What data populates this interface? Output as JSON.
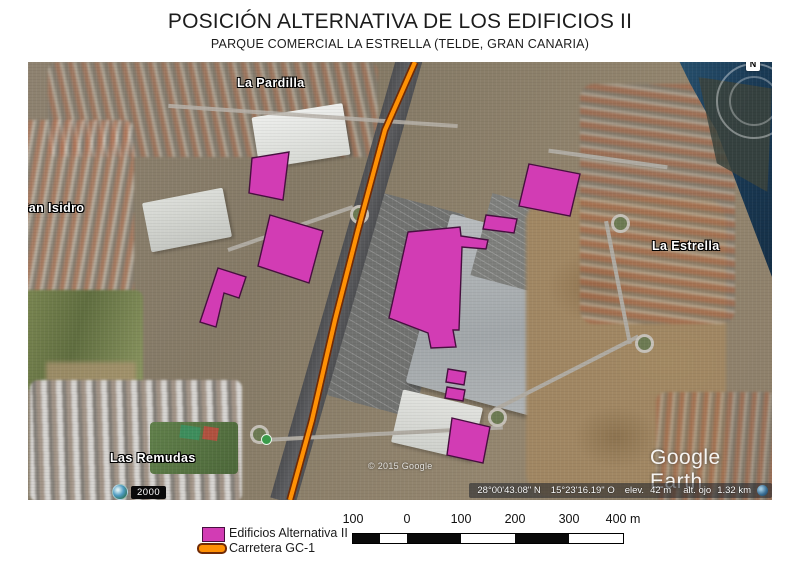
{
  "header": {
    "title": "POSICIÓN ALTERNATIVA DE LOS EDIFICIOS II",
    "subtitle": "PARQUE COMERCIAL LA ESTRELLA (TELDE, GRAN CANARIA)"
  },
  "map": {
    "place_labels": [
      {
        "name": "La Pardilla",
        "x": 209,
        "y": 14
      },
      {
        "name": "San Isidro",
        "x": -8,
        "y": 139
      },
      {
        "name": "La Estrella",
        "x": 624,
        "y": 177
      },
      {
        "name": "Las Remudas",
        "x": 82,
        "y": 389
      }
    ],
    "watermark": "Google Earth",
    "copyright": "© 2015 Google",
    "year_badge": "2000",
    "compass_label": "N",
    "status_bar": {
      "latitude": "28°00'43.08\" N",
      "longitude": "15°23'16.19\" O",
      "elev_label": "elev.",
      "elev_value": "42 m",
      "eye_label": "alt. ojo",
      "eye_value": "1.32 km"
    },
    "icons": {
      "year_badge": "clock-icon",
      "status_right": "globe-icon",
      "map_poi": "photo-icon"
    },
    "overlays": {
      "building_color": "#d23cb4",
      "building_outline": "#470f3f",
      "road_color": "#ff9105",
      "road_casing": "#712b06",
      "buildings": [
        {
          "points": "224,96 261,90 255,138 221,131"
        },
        {
          "points": "242,153 295,169 281,221 230,204"
        },
        {
          "points": "190,206 218,215 211,236 196,231 188,265 172,260"
        },
        {
          "points": "380,170 432,165 433,174 460,178 458,187 434,185 431,268 425,268 428,285 403,286 400,271 361,256"
        },
        {
          "points": "458,153 489,157 486,171 455,167"
        },
        {
          "points": "501,102 552,112 542,154 491,144"
        },
        {
          "points": "420,307 438,310 436,323 418,320"
        },
        {
          "points": "419,325 437,328 435,339 417,336"
        },
        {
          "points": "424,356 462,365 455,401 419,393"
        }
      ],
      "road_path": "387,0 357,68 330,168 307,258 284,358 262,438"
    }
  },
  "legend": {
    "items": [
      {
        "label": "Edificios Alternativa II",
        "type": "building"
      },
      {
        "label": "Carretera GC-1",
        "type": "road"
      }
    ]
  },
  "scale_bar": {
    "tick_labels": [
      "100",
      "0",
      "100",
      "200",
      "300",
      "400 m"
    ],
    "segments": [
      "black",
      "white",
      "black",
      "white",
      "black",
      "white"
    ]
  }
}
